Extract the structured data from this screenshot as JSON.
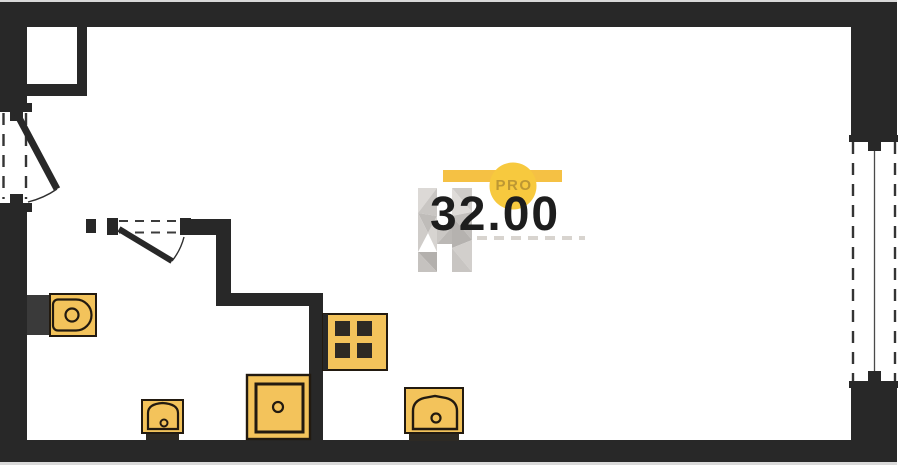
{
  "watermark": {
    "badge_label": "PRO",
    "area_value": "32.00",
    "bar_color": "#f5c144",
    "circle_color": "#f7c93e",
    "badge_text_color": "#bd9733",
    "value_color": "#1d1d1d",
    "logo": "faceted-h-monogram"
  },
  "floor_plan": {
    "wall_color": "#282828",
    "fixture_fill": "#f3c35b",
    "fixture_stroke": "#221a10",
    "fixtures": [
      {
        "name": "toilet",
        "room": "bathroom"
      },
      {
        "name": "washbasin",
        "room": "bathroom"
      },
      {
        "name": "shower-tray",
        "room": "bathroom"
      },
      {
        "name": "cooktop-4-burner",
        "room": "kitchen"
      },
      {
        "name": "sink",
        "room": "kitchen"
      }
    ],
    "openings": [
      {
        "name": "entrance-door",
        "wall": "left",
        "type": "swing-door"
      },
      {
        "name": "bathroom-door",
        "wall": "interior",
        "type": "swing-door"
      },
      {
        "name": "window",
        "wall": "right",
        "type": "full-height-window"
      },
      {
        "name": "duct-shaft",
        "wall": "top-left",
        "type": "shaft"
      }
    ]
  }
}
